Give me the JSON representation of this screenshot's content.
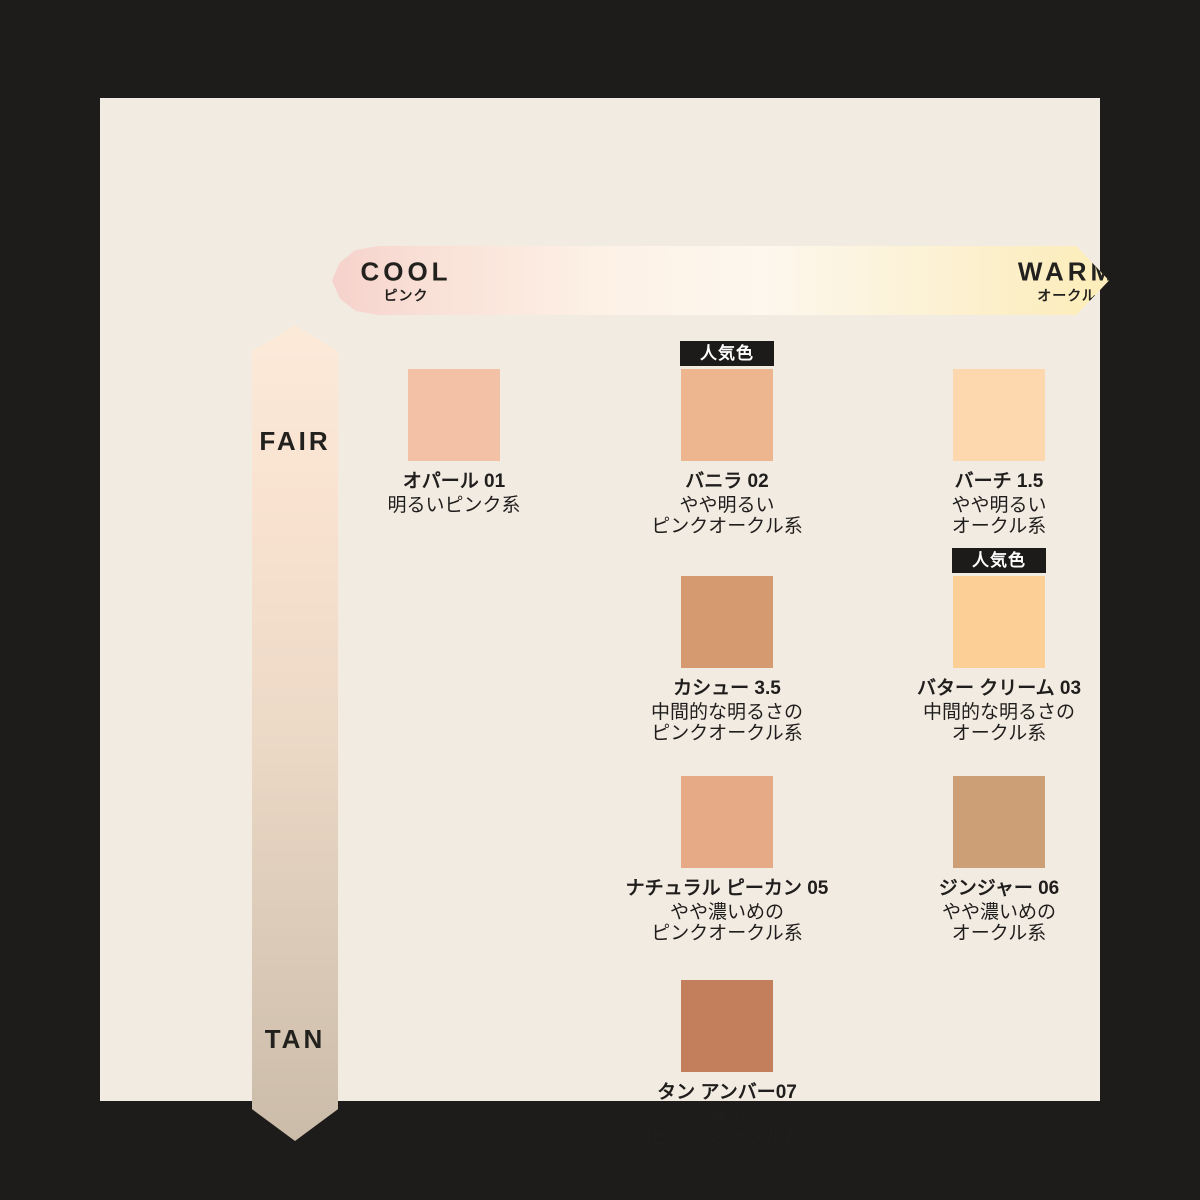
{
  "page": {
    "frame_color": "#1d1c1a",
    "panel_color": "#f1ebe2",
    "text_color": "#201e1c"
  },
  "axes": {
    "horizontal": {
      "left_label": "COOL",
      "left_sublabel": "ピンク",
      "right_label": "WARM",
      "right_sublabel": "オークル",
      "gradient_colors": [
        "#f6d2cc",
        "#fdf7ee",
        "#fdedb9"
      ]
    },
    "vertical": {
      "top_label": "FAIR",
      "bottom_label": "TAN",
      "gradient_colors": [
        "#fcead9",
        "#cbbca9"
      ]
    }
  },
  "badge_label": "人気色",
  "badge_colors": {
    "background": "#1d1b19",
    "text": "#ffffff"
  },
  "shades": [
    {
      "name": "オパール 01",
      "desc": "明るいピンク系",
      "color": "#f3c1a5",
      "popular": false,
      "row": 1,
      "col": 1
    },
    {
      "name": "バニラ 02",
      "desc": "やや明るい\nピンクオークル系",
      "color": "#eeb68f",
      "popular": true,
      "row": 1,
      "col": 2
    },
    {
      "name": "バーチ 1.5",
      "desc": "やや明るい\nオークル系",
      "color": "#fdd8ae",
      "popular": false,
      "row": 1,
      "col": 3
    },
    {
      "name": "カシュー 3.5",
      "desc": "中間的な明るさの\nピンクオークル系",
      "color": "#d69a71",
      "popular": false,
      "row": 2,
      "col": 2
    },
    {
      "name": "バター クリーム 03",
      "desc": "中間的な明るさの\nオークル系",
      "color": "#fccf97",
      "popular": true,
      "row": 2,
      "col": 3
    },
    {
      "name": "ナチュラル ピーカン 05",
      "desc": "やや濃いめの\nピンクオークル系",
      "color": "#e7aa87",
      "popular": false,
      "row": 3,
      "col": 2
    },
    {
      "name": "ジンジャー 06",
      "desc": "やや濃いめの\nオークル系",
      "color": "#cd9f77",
      "popular": false,
      "row": 3,
      "col": 3
    },
    {
      "name": "タン アンバー07",
      "desc": "濃い\nピンクオークル系",
      "color": "#c37f5b",
      "popular": false,
      "row": 4,
      "col": 2
    }
  ]
}
